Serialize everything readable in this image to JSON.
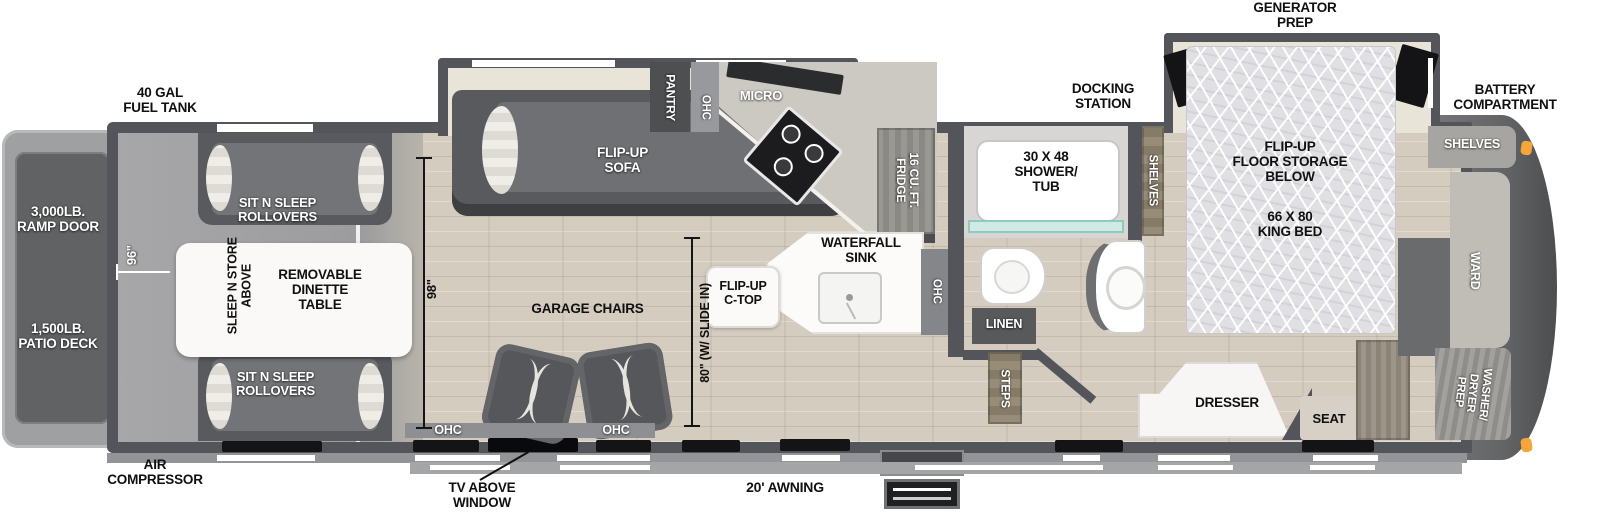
{
  "labels": {
    "fuel_tank": "40 GAL\nFUEL TANK",
    "generator_prep": "GENERATOR\nPREP",
    "docking_station": "DOCKING\nSTATION",
    "battery_compartment": "BATTERY\nCOMPARTMENT",
    "ramp_door": "3,000LB.\nRAMP DOOR",
    "patio_deck": "1,500LB.\nPATIO DECK",
    "air_compressor": "AIR\nCOMPRESSOR",
    "tv_above_window": "TV ABOVE\nWINDOW",
    "awning": "20' AWNING",
    "dim_garage_width": "96\"",
    "dim_interior_height": "98\"",
    "dim_slide_width": "80\" (W/ SLIDE IN)",
    "sit_n_sleep_top": "SIT N SLEEP\nROLLOVERS",
    "sit_n_sleep_bottom": "SIT N SLEEP\nROLLOVERS",
    "sleep_n_store": "SLEEP N STORE\nABOVE",
    "dinette_table": "REMOVABLE\nDINETTE\nTABLE",
    "garage_chairs": "GARAGE CHAIRS",
    "ohc_left": "OHC",
    "ohc_mid": "OHC",
    "flip_up_sofa": "FLIP-UP\nSOFA",
    "pantry": "PANTRY",
    "ohc_kitchen": "OHC",
    "micro": "MICRO",
    "fridge": "16 CU. FT.\nFRIDGE",
    "waterfall_sink": "WATERFALL\nSINK",
    "flip_up_ctop": "FLIP-UP\nC-TOP",
    "ohc_island": "OHC",
    "shower_tub": "30 X 48\nSHOWER/\nTUB",
    "linen": "LINEN",
    "steps": "STEPS",
    "shelves_inner": "SHELVES",
    "shelves_front": "SHELVES",
    "floor_storage": "FLIP-UP\nFLOOR STORAGE\nBELOW",
    "king_bed": "66 X 80\nKING BED",
    "dresser": "DRESSER",
    "seat": "SEAT",
    "ward": "WARD",
    "washer_dryer": "WASHER/\nDRYER\nPREP"
  },
  "colors": {
    "wall": "#54555a",
    "wood_floor": "#d5ccc0",
    "garage_floor": "#a2a2a4",
    "slide_interior": "#e8e4d8",
    "furniture_dark": "#595a5d",
    "counter_white": "#fcfbf9",
    "shower_glass": "#9fd4c8",
    "marker_light": "#f4a63b",
    "front_cap": "#68696b"
  }
}
